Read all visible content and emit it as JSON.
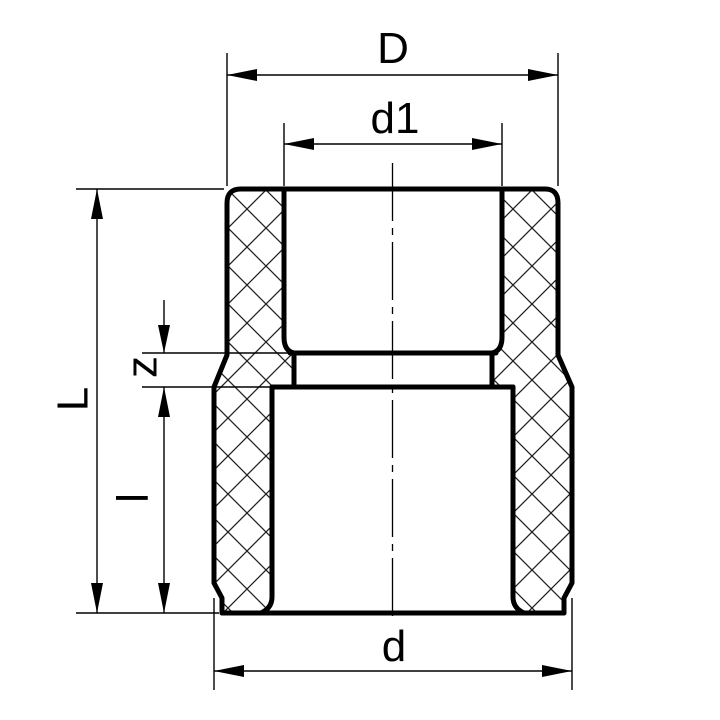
{
  "dimension_labels": {
    "outer_diameter_top": "D",
    "bore_diameter_top": "d1",
    "overall_height": "L",
    "middle_step_height": "z",
    "lower_height": "l",
    "outer_diameter_bottom": "d"
  },
  "colors": {
    "line": "#000000",
    "hatch": "#222222",
    "background": "#ffffff"
  }
}
